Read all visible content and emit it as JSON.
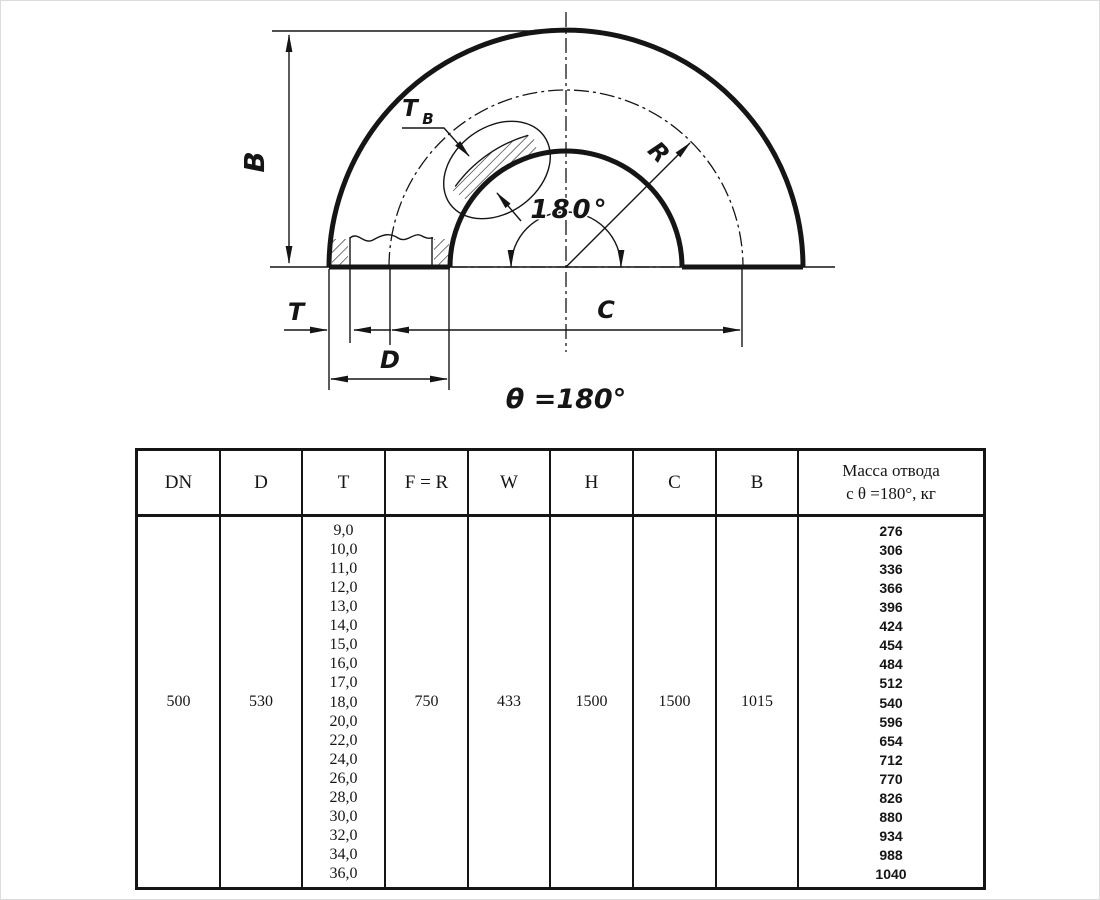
{
  "colors": {
    "ink": "#151515",
    "background": "#ffffff"
  },
  "drawing": {
    "caption": "θ =180°",
    "angle_label": "180°",
    "labels": {
      "B": "B",
      "T": "T",
      "D": "D",
      "C": "C",
      "R": "R",
      "wall": "T",
      "wall_sub": "B"
    }
  },
  "table": {
    "headers": {
      "dn": "DN",
      "d": "D",
      "t": "T",
      "fr": "F = R",
      "w": "W",
      "h": "H",
      "c": "C",
      "b": "B",
      "mass": "Масса отвода\nс θ =180°, кг"
    },
    "values": {
      "dn": "500",
      "d": "530",
      "fr": "750",
      "w": "433",
      "h": "1500",
      "c": "1500",
      "b": "1015"
    },
    "t_values": [
      "9,0",
      "10,0",
      "11,0",
      "12,0",
      "13,0",
      "14,0",
      "15,0",
      "16,0",
      "17,0",
      "18,0",
      "20,0",
      "22,0",
      "24,0",
      "26,0",
      "28,0",
      "30,0",
      "32,0",
      "34,0",
      "36,0"
    ],
    "mass_values": [
      "276",
      "306",
      "336",
      "366",
      "396",
      "424",
      "454",
      "484",
      "512",
      "540",
      "596",
      "654",
      "712",
      "770",
      "826",
      "880",
      "934",
      "988",
      "1040"
    ]
  }
}
